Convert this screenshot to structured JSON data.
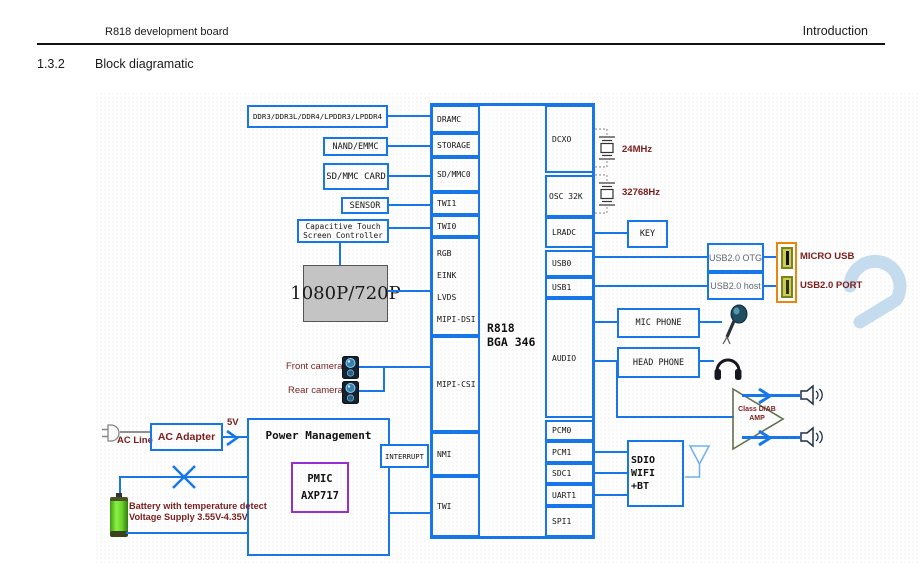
{
  "header": {
    "doc_title": "R818 development board",
    "page_section": "Introduction"
  },
  "section": {
    "number": "1.3.2",
    "title": "Block diagramatic"
  },
  "chip": {
    "title_line1": "R818",
    "title_line2": "BGA 346",
    "left_ports": [
      "DRAMC",
      "STORAGE",
      "SD/MMC0",
      "TWI1",
      "TWI0"
    ],
    "display_ports": [
      "RGB",
      "EINK",
      "LVDS",
      "MIPI-DSI"
    ],
    "csi_port": "MIPI-CSI",
    "nmi_port": "NMI",
    "twi_port": "TWI",
    "right_ports": [
      "DCXO",
      "OSC 32K",
      "LRADC",
      "USB0",
      "USB1",
      "AUDIO",
      "PCM0",
      "PCM1",
      "SDC1",
      "UART1",
      "SPI1"
    ]
  },
  "memory": {
    "ddr": "DDR3/DDR3L/DDR4/LPDDR3/LPDDR4",
    "nand": "NAND/EMMC",
    "sd_card": "SD/MMC CARD"
  },
  "input": {
    "sensor": "SENSOR",
    "touch_line1": "Capacitive Touch",
    "touch_line2": "Screen Controller"
  },
  "display": {
    "panel": "1080P/720P"
  },
  "camera": {
    "front": "Front camera",
    "rear": "Rear camera"
  },
  "clock": {
    "xtal_24m": "24MHz",
    "xtal_32k": "32768Hz"
  },
  "key": {
    "label": "KEY"
  },
  "usb": {
    "otg": "USB2.0 OTG",
    "host": "USB2.0 host",
    "micro_usb": "MICRO USB",
    "usb_port": "USB2.0 PORT"
  },
  "audio": {
    "mic": "MIC PHONE",
    "headphone": "HEAD PHONE",
    "amp_line1": "Class D/AB",
    "amp_line2": "AMP"
  },
  "wireless": {
    "sdio_line1": "SDIO WIFI",
    "sdio_line2": "+BT"
  },
  "power": {
    "ac_line": "AC Line",
    "ac_adapter": "AC Adapter",
    "rail_5v": "5V",
    "pm_title": "Power Management",
    "pmic": "PMIC",
    "pmic_model": "AXP717",
    "interrupt": "INTERRUPT",
    "battery_line1": "Battery with temperature detect",
    "battery_line2": "Voltage Supply 3.55V-4.35V"
  },
  "colors": {
    "wire_blue": "#1777e8",
    "label_maroon": "#7b1d1d",
    "pmic_purple": "#9430d0",
    "connector_orange": "#e8860f",
    "panel_gray": "#c4c4c4"
  }
}
